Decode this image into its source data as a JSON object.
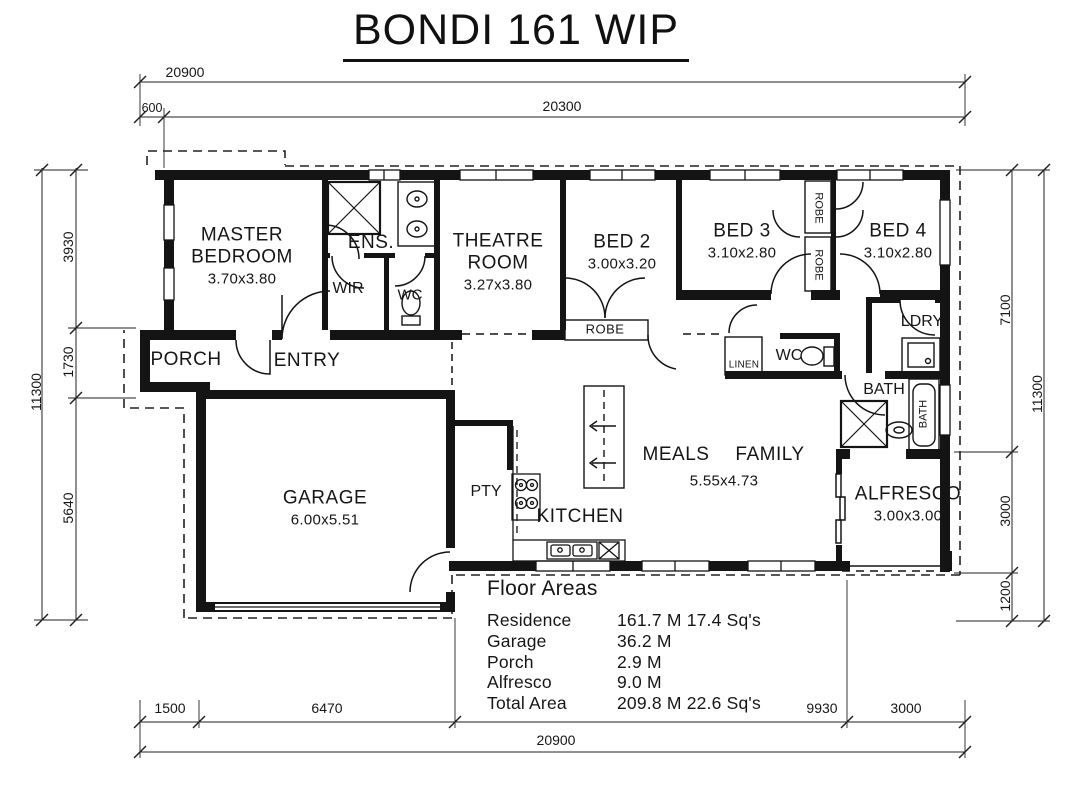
{
  "title": "BONDI 161 WIP",
  "rooms": {
    "master": {
      "name": "MASTER BEDROOM",
      "size": "3.70x3.80"
    },
    "ens": "ENS.",
    "wir": "WIR",
    "wc": "WC",
    "theatre": {
      "name": "THEATRE ROOM",
      "size": "3.27x3.80"
    },
    "bed2": {
      "name": "BED 2",
      "size": "3.00x3.20"
    },
    "bed3": {
      "name": "BED 3",
      "size": "3.10x2.80"
    },
    "bed4": {
      "name": "BED 4",
      "size": "3.10x2.80"
    },
    "robe": "ROBE",
    "porch": "PORCH",
    "entry": "ENTRY",
    "linen": "LINEN",
    "ldry": "LDRY",
    "bath": "BATH",
    "garage": {
      "name": "GARAGE",
      "size": "6.00x5.51"
    },
    "pty": "PTY",
    "kitchen": "KITCHEN",
    "meals": "MEALS",
    "family": "FAMILY",
    "meals_family_size": "5.55x4.73",
    "alfresco": {
      "name": "ALFRESCO",
      "size": "3.00x3.00"
    }
  },
  "dimensions": {
    "top": {
      "overall": "20900",
      "offset": "600",
      "main": "20300"
    },
    "left": {
      "overall": "11300",
      "seg1": "3930",
      "seg2": "1730",
      "seg3": "5640"
    },
    "right": {
      "overall": "11300",
      "seg1": "7100",
      "seg2": "3000",
      "seg3": "1200"
    },
    "bottom": {
      "overall": "20900",
      "seg1": "1500",
      "seg2": "6470",
      "seg3": "9930",
      "seg4": "3000"
    }
  },
  "floor_areas": {
    "title": "Floor Areas",
    "rows": [
      {
        "label": "Residence",
        "value": "161.7 M 17.4 Sq's"
      },
      {
        "label": "Garage",
        "value": "36.2 M"
      },
      {
        "label": "Porch",
        "value": "2.9 M"
      },
      {
        "label": "Alfresco",
        "value": "9.0 M"
      },
      {
        "label": "Total Area",
        "value": "209.8 M 22.6 Sq's"
      }
    ]
  },
  "colors": {
    "line": "#161616",
    "background": "#ffffff"
  }
}
